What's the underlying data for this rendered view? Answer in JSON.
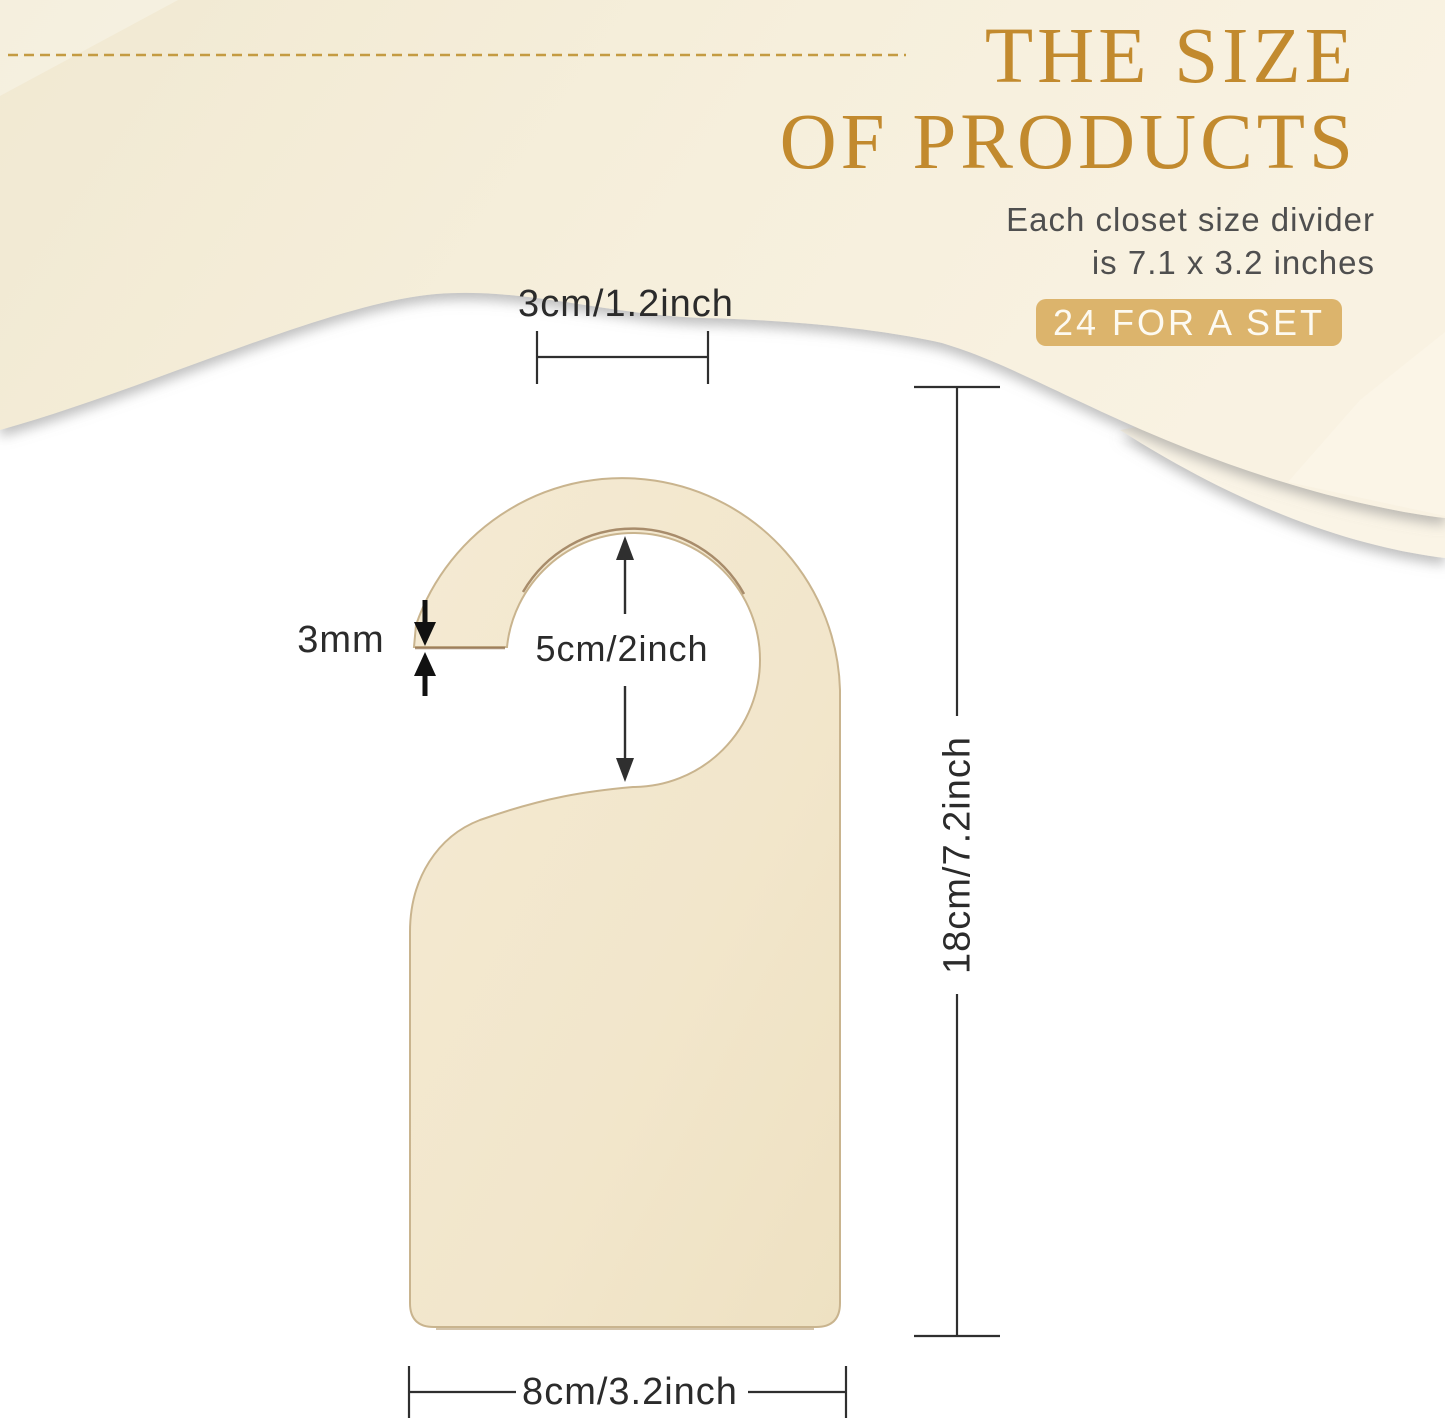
{
  "header": {
    "title_line1": "THE SIZE",
    "title_line2": "OF PRODUCTS",
    "subtitle_line1": "Each closet size divider",
    "subtitle_line2": "is 7.1 x 3.2 inches",
    "badge_label": "24 FOR A SET",
    "title_color": "#c28a2e",
    "badge_bg_color": "#dcb46c",
    "wave_color": "#f5eeda"
  },
  "diagram": {
    "product": "wooden closet size divider door hanger",
    "wood_color": "#f3e8cf",
    "dimension_line_color": "#2f2f2f",
    "labels": {
      "hook_top_width": "3cm/1.2inch",
      "hole_diameter": "5cm/2inch",
      "board_thickness": "3mm",
      "total_height": "18cm/7.2inch",
      "total_width": "8cm/3.2inch"
    }
  }
}
